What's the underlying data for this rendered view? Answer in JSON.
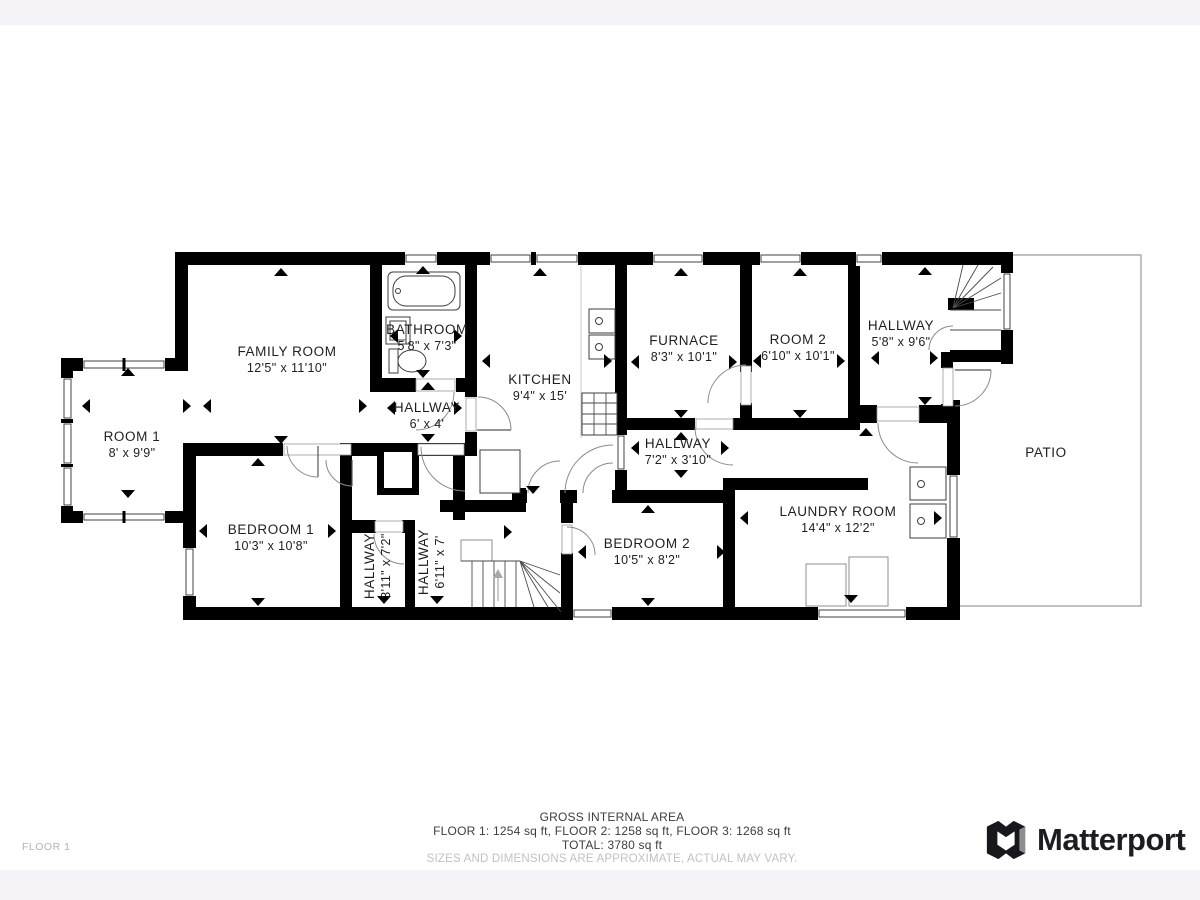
{
  "floorplan": {
    "floor_label": "FLOOR 1",
    "rooms": {
      "family_room": {
        "name": "FAMILY ROOM",
        "dims": "12'5\" x 11'10\""
      },
      "room1": {
        "name": "ROOM 1",
        "dims": "8' x 9'9\""
      },
      "bathroom": {
        "name": "BATHROOM",
        "dims": "5'8\" x 7'3\""
      },
      "kitchen": {
        "name": "KITCHEN",
        "dims": "9'4\" x 15'"
      },
      "hallway_top": {
        "name": "HALLWAY",
        "dims": "6' x 4'"
      },
      "furnace": {
        "name": "FURNACE",
        "dims": "8'3\" x 10'1\""
      },
      "room2": {
        "name": "ROOM 2",
        "dims": "6'10\" x 10'1\""
      },
      "hallway_stairs": {
        "name": "HALLWAY",
        "dims": "5'8\" x 9'6\""
      },
      "hallway_mid": {
        "name": "HALLWAY",
        "dims": "7'2\" x 3'10\""
      },
      "laundry": {
        "name": "LAUNDRY ROOM",
        "dims": "14'4\" x 12'2\""
      },
      "bedroom1": {
        "name": "BEDROOM 1",
        "dims": "10'3\" x 10'8\""
      },
      "hallway_b1": {
        "name": "HALLWAY",
        "dims": "3'11\" x 7'2\""
      },
      "hallway_b2": {
        "name": "HALLWAY",
        "dims": "6'11\" x 7'"
      },
      "bedroom2": {
        "name": "BEDROOM 2",
        "dims": "10'5\" x 8'2\""
      },
      "patio": {
        "name": "PATIO"
      }
    },
    "footer": {
      "title": "GROSS INTERNAL AREA",
      "floors_line": "FLOOR 1: 1254 sq ft, FLOOR 2: 1258 sq ft, FLOOR 3: 1268 sq ft",
      "total_line": "TOTAL: 3780 sq ft",
      "disclaimer": "SIZES AND DIMENSIONS ARE APPROXIMATE, ACTUAL MAY VARY."
    },
    "brand": {
      "logo_text": "Matterport"
    }
  }
}
